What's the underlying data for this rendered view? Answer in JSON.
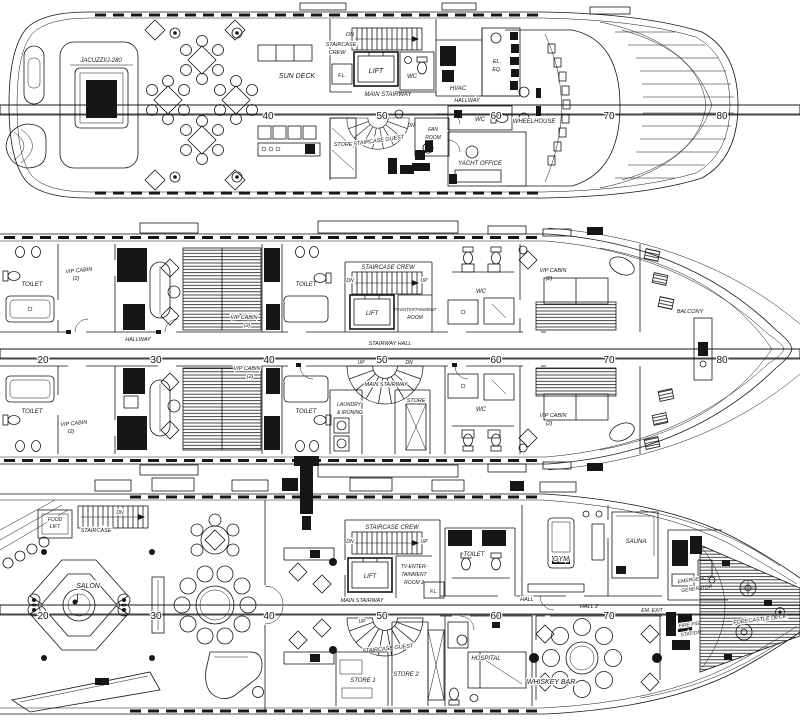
{
  "palette": {
    "ink": "#161616",
    "paper": "#ffffff"
  },
  "rulers": {
    "d1": [
      "40",
      "50",
      "60",
      "70",
      "80"
    ],
    "d2": [
      "20",
      "30",
      "40",
      "50",
      "60",
      "70",
      "80"
    ],
    "d3": [
      "20",
      "30",
      "40",
      "50",
      "60",
      "70"
    ]
  },
  "d1": {
    "jacuzzi": "JACUZZI/J-280",
    "sun_deck": "SUN DECK",
    "dn_crew": "DN",
    "staircase": "STAIRCASE",
    "crew": "CREW",
    "fl": "F.L.",
    "lift": "LIFT",
    "wc_top": "WC",
    "main_stairway": "MAIN STAIRWAY",
    "hvac": "HVAC",
    "el": "EL.",
    "eq": "EQ.",
    "hallway": "HALLWAY",
    "store": "STORE",
    "staircase_guest": "STAIRCASE GUEST",
    "dn_guest": "DN",
    "fan": "FAN",
    "fan2": "ROOM",
    "wc_mid": "WC",
    "wheelhouse": "WHEELHOUSE",
    "yacht_office": "YACHT OFFICE"
  },
  "d2": {
    "toilet_a": "TOILET",
    "vip_a": "VIP CABIN",
    "vip_a2": "(2)",
    "toilet_b": "TOILET",
    "vip_b": "VIP CABIN",
    "vip_b2": "(2)",
    "staircase_crew": "STAIRCASE CREW",
    "dn": "DN",
    "up": "UP",
    "lift": "LIFT",
    "tv1": "TV-ENTERTAINMENT",
    "tv2": "ROOM",
    "wc_u": "WC",
    "vip_c": "VIP CABIN",
    "vip_c2": "(2)",
    "balcony": "BALCONY",
    "hallway": "HALLWAY",
    "stairway_hall": "STAIRWAY HALL",
    "up2": "UP",
    "dn2": "DN",
    "main_stairway": "MAIN STAIRWAY",
    "laundry1": "LAUNDRY",
    "laundry2": "& IRONING",
    "store": "STORE",
    "wc_l": "WC",
    "toilet_c": "TOILET",
    "vip_d": "VIP CABIN",
    "vip_d2": "(2)",
    "toilet_d": "TOILET",
    "vip_e": "VIP CABIN",
    "vip_e2": "(2)",
    "vip_f": "VIP CABIN",
    "vip_f2": "(2)"
  },
  "d3": {
    "food": "FOOD",
    "food2": "LIFT",
    "dn_aft": "DN",
    "staircase_aft": "STAIRCASE",
    "salon": "SALON",
    "staircase_crew": "STAIRCASE CREW",
    "dn": "DN",
    "up": "UP",
    "lift": "LIFT",
    "tv1": "TV-ENTER-",
    "tv2": "TAINMENT",
    "tv3": "ROOM 2",
    "fl": "F.L.",
    "toilet": "TOILET",
    "main_stairway": "MAIN STAIRWAY",
    "hall": "HALL",
    "hall2": "HALL 2",
    "em_exit": "EM. EXIT",
    "gym": "GYM",
    "sauna": "SAUNA",
    "emergency1": "EMERGENCY",
    "emergency2": "GENERATOR",
    "up2": "UP",
    "staircase_guest": "STAIRCASE GUEST",
    "store1": "STORE 1",
    "store2": "STORE 2",
    "hospital": "HOSPITAL",
    "whiskey": "WHISKEY BAR",
    "fire1": "FIRE FIG.",
    "fire2": "STATION",
    "forecastle": "FORECASTLE DECK"
  }
}
